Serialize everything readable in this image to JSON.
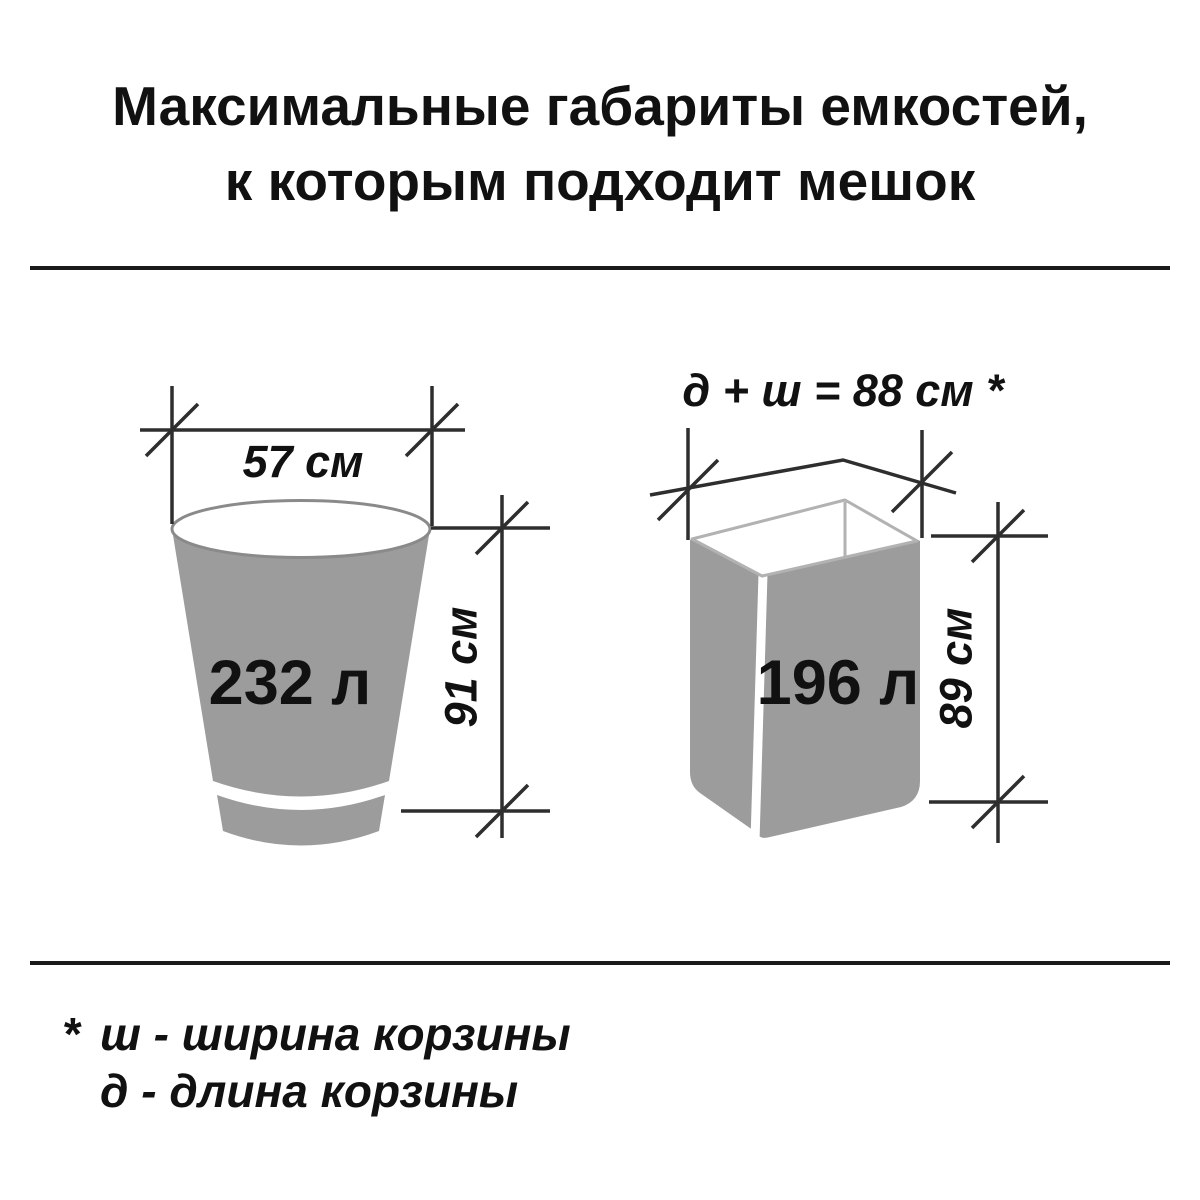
{
  "title": {
    "line1": "Максимальные габариты емкостей,",
    "line2": "к которым подходит мешок"
  },
  "bucket": {
    "volume_label": "232 л",
    "width_label": "57 см",
    "height_label": "91 см"
  },
  "basket": {
    "volume_label": "196 л",
    "perimeter_label": "д + ш = 88 см *",
    "height_label": "89 см"
  },
  "footnote": {
    "asterisk": "*",
    "line1": "ш - ширина корзины",
    "line2": "д - длина корзины"
  },
  "colors": {
    "background": "#ffffff",
    "text": "#111111",
    "container_fill": "#9c9c9c",
    "rim_stroke": "#8a8a8a",
    "basket_inner_stroke": "#b2b2b2",
    "dimension_line": "#2e2e2e",
    "divider": "#1a1a1a"
  }
}
